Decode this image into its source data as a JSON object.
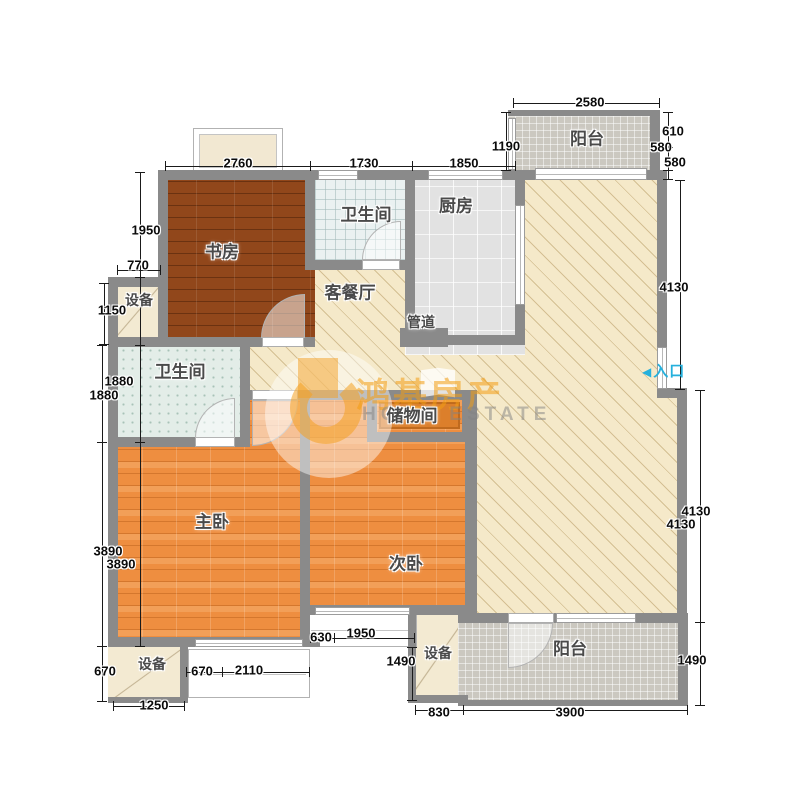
{
  "watermark": {
    "brand": "鸿基房产",
    "brand_en": "HOME ESTATE"
  },
  "entrance": {
    "arrow": "◀",
    "label": "入口",
    "color": "#25b0dc"
  },
  "colors": {
    "wall": "#8a8a8a",
    "living_floor": "#f5e9c9",
    "study_floor": "#91471b",
    "bedroom_floor": "#ee8e40",
    "kitchen_floor": "#e2e2e2",
    "bath_floor": "#eaf1f1",
    "balcony_floor": "#cbc8c0",
    "watermark_orange": "#f39c12",
    "entrance_cyan": "#25b0dc"
  },
  "room_labels": [
    {
      "key": "study",
      "label": "书房",
      "x": 222,
      "y": 252
    },
    {
      "key": "bath-top",
      "label": "卫生间",
      "x": 366,
      "y": 215
    },
    {
      "key": "kitchen",
      "label": "厨房",
      "x": 456,
      "y": 206
    },
    {
      "key": "balcony-top",
      "label": "阳台",
      "x": 587,
      "y": 139
    },
    {
      "key": "living-dining",
      "label": "客餐厅",
      "x": 350,
      "y": 293
    },
    {
      "key": "pipe-duct",
      "label": "管道",
      "x": 421,
      "y": 322,
      "cls": "small"
    },
    {
      "key": "equipment-left",
      "label": "设备",
      "x": 139,
      "y": 300,
      "cls": "small"
    },
    {
      "key": "bath-left",
      "label": "卫生间",
      "x": 180,
      "y": 372
    },
    {
      "key": "storage",
      "label": "储物间",
      "x": 412,
      "y": 416
    },
    {
      "key": "master-bedroom",
      "label": "主卧",
      "x": 212,
      "y": 522
    },
    {
      "key": "second-bedroom",
      "label": "次卧",
      "x": 406,
      "y": 564
    },
    {
      "key": "equipment-bottom-left",
      "label": "设备",
      "x": 152,
      "y": 664,
      "cls": "small"
    },
    {
      "key": "equipment-bottom-mid",
      "label": "设备",
      "x": 438,
      "y": 653,
      "cls": "small"
    },
    {
      "key": "balcony-bottom",
      "label": "阳台",
      "x": 570,
      "y": 649
    }
  ],
  "dimensions": [
    {
      "text": "2760",
      "x": 238,
      "y": 163
    },
    {
      "text": "1730",
      "x": 364,
      "y": 163
    },
    {
      "text": "1850",
      "x": 464,
      "y": 163
    },
    {
      "text": "1190",
      "x": 506,
      "y": 146
    },
    {
      "text": "2580",
      "x": 590,
      "y": 102
    },
    {
      "text": "610",
      "x": 673,
      "y": 131
    },
    {
      "text": "580",
      "x": 661,
      "y": 147
    },
    {
      "text": "580",
      "x": 675,
      "y": 162
    },
    {
      "text": "1950",
      "x": 146,
      "y": 230
    },
    {
      "text": "770",
      "x": 138,
      "y": 265
    },
    {
      "text": "1150",
      "x": 112,
      "y": 310
    },
    {
      "text": "1880",
      "x": 119,
      "y": 381
    },
    {
      "text": "1880",
      "x": 104,
      "y": 395
    },
    {
      "text": "3890",
      "x": 108,
      "y": 551
    },
    {
      "text": "3890",
      "x": 121,
      "y": 564
    },
    {
      "text": "670",
      "x": 105,
      "y": 671
    },
    {
      "text": "1250",
      "x": 154,
      "y": 705
    },
    {
      "text": "670",
      "x": 202,
      "y": 671
    },
    {
      "text": "2110",
      "x": 249,
      "y": 670
    },
    {
      "text": "630",
      "x": 321,
      "y": 637
    },
    {
      "text": "1950",
      "x": 361,
      "y": 633
    },
    {
      "text": "1490",
      "x": 401,
      "y": 661
    },
    {
      "text": "830",
      "x": 439,
      "y": 712
    },
    {
      "text": "3900",
      "x": 570,
      "y": 712
    },
    {
      "text": "4130",
      "x": 674,
      "y": 287
    },
    {
      "text": "4130",
      "x": 696,
      "y": 511
    },
    {
      "text": "4130",
      "x": 681,
      "y": 524
    },
    {
      "text": "1490",
      "x": 692,
      "y": 660
    }
  ],
  "dim_lines": [
    {
      "x": 165,
      "y": 166,
      "w": 350,
      "h": 1
    },
    {
      "x": 165,
      "y": 161,
      "w": 1,
      "h": 10
    },
    {
      "x": 310,
      "y": 161,
      "w": 1,
      "h": 10
    },
    {
      "x": 412,
      "y": 161,
      "w": 1,
      "h": 10
    },
    {
      "x": 515,
      "y": 161,
      "w": 1,
      "h": 10
    },
    {
      "x": 513,
      "y": 103,
      "w": 147,
      "h": 1
    },
    {
      "x": 513,
      "y": 98,
      "w": 1,
      "h": 10
    },
    {
      "x": 659,
      "y": 98,
      "w": 1,
      "h": 10
    },
    {
      "x": 506,
      "y": 112,
      "w": 1,
      "h": 59
    },
    {
      "x": 501,
      "y": 112,
      "w": 10,
      "h": 1
    },
    {
      "x": 501,
      "y": 170,
      "w": 10,
      "h": 1
    },
    {
      "x": 668,
      "y": 112,
      "w": 1,
      "h": 68
    },
    {
      "x": 663,
      "y": 112,
      "w": 10,
      "h": 1
    },
    {
      "x": 663,
      "y": 147,
      "w": 10,
      "h": 1
    },
    {
      "x": 663,
      "y": 170,
      "w": 10,
      "h": 1
    },
    {
      "x": 663,
      "y": 179,
      "w": 10,
      "h": 1
    },
    {
      "x": 140,
      "y": 172,
      "w": 1,
      "h": 475
    },
    {
      "x": 135,
      "y": 172,
      "w": 10,
      "h": 1
    },
    {
      "x": 135,
      "y": 277,
      "w": 10,
      "h": 1
    },
    {
      "x": 135,
      "y": 345,
      "w": 10,
      "h": 1
    },
    {
      "x": 135,
      "y": 442,
      "w": 10,
      "h": 1
    },
    {
      "x": 135,
      "y": 646,
      "w": 10,
      "h": 1
    },
    {
      "x": 117,
      "y": 270,
      "w": 44,
      "h": 1
    },
    {
      "x": 117,
      "y": 265,
      "w": 1,
      "h": 10
    },
    {
      "x": 160,
      "y": 265,
      "w": 1,
      "h": 10
    },
    {
      "x": 104,
      "y": 283,
      "w": 1,
      "h": 62
    },
    {
      "x": 99,
      "y": 283,
      "w": 10,
      "h": 1
    },
    {
      "x": 99,
      "y": 344,
      "w": 10,
      "h": 1
    },
    {
      "x": 102,
      "y": 345,
      "w": 1,
      "h": 357
    },
    {
      "x": 97,
      "y": 345,
      "w": 10,
      "h": 1
    },
    {
      "x": 97,
      "y": 442,
      "w": 10,
      "h": 1
    },
    {
      "x": 97,
      "y": 646,
      "w": 10,
      "h": 1
    },
    {
      "x": 97,
      "y": 701,
      "w": 10,
      "h": 1
    },
    {
      "x": 186,
      "y": 672,
      "w": 124,
      "h": 1
    },
    {
      "x": 186,
      "y": 667,
      "w": 1,
      "h": 10
    },
    {
      "x": 222,
      "y": 667,
      "w": 1,
      "h": 10
    },
    {
      "x": 309,
      "y": 667,
      "w": 1,
      "h": 10
    },
    {
      "x": 113,
      "y": 706,
      "w": 72,
      "h": 1
    },
    {
      "x": 113,
      "y": 701,
      "w": 1,
      "h": 10
    },
    {
      "x": 184,
      "y": 701,
      "w": 1,
      "h": 10
    },
    {
      "x": 310,
      "y": 638,
      "w": 105,
      "h": 1
    },
    {
      "x": 310,
      "y": 633,
      "w": 1,
      "h": 10
    },
    {
      "x": 334,
      "y": 633,
      "w": 1,
      "h": 10
    },
    {
      "x": 414,
      "y": 633,
      "w": 1,
      "h": 10
    },
    {
      "x": 412,
      "y": 647,
      "w": 1,
      "h": 54
    },
    {
      "x": 407,
      "y": 647,
      "w": 10,
      "h": 1
    },
    {
      "x": 407,
      "y": 700,
      "w": 10,
      "h": 1
    },
    {
      "x": 415,
      "y": 710,
      "w": 273,
      "h": 1
    },
    {
      "x": 415,
      "y": 705,
      "w": 1,
      "h": 10
    },
    {
      "x": 463,
      "y": 705,
      "w": 1,
      "h": 10
    },
    {
      "x": 687,
      "y": 705,
      "w": 1,
      "h": 10
    },
    {
      "x": 680,
      "y": 180,
      "w": 1,
      "h": 210
    },
    {
      "x": 675,
      "y": 180,
      "w": 10,
      "h": 1
    },
    {
      "x": 675,
      "y": 389,
      "w": 10,
      "h": 1
    },
    {
      "x": 700,
      "y": 390,
      "w": 1,
      "h": 316
    },
    {
      "x": 695,
      "y": 390,
      "w": 10,
      "h": 1
    },
    {
      "x": 695,
      "y": 622,
      "w": 10,
      "h": 1
    },
    {
      "x": 695,
      "y": 705,
      "w": 10,
      "h": 1
    }
  ]
}
